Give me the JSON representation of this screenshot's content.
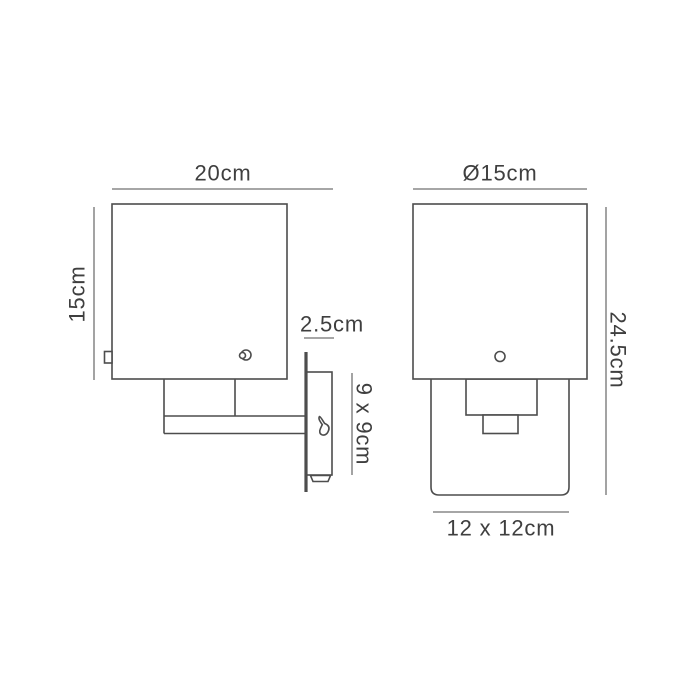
{
  "colors": {
    "background": "#ffffff",
    "outline": "#4d4d4d",
    "dimension_line": "#999999",
    "text": "#3f3f3f"
  },
  "views": {
    "side": {
      "labels": {
        "projection_width": "20cm",
        "shade_height": "15cm",
        "backplate_depth": "2.5cm",
        "bracket_size": "9 x 9cm"
      }
    },
    "front": {
      "labels": {
        "shade_width": "Ø15cm",
        "overall_height": "24.5cm",
        "backplate_size": "12 x 12cm"
      }
    }
  }
}
